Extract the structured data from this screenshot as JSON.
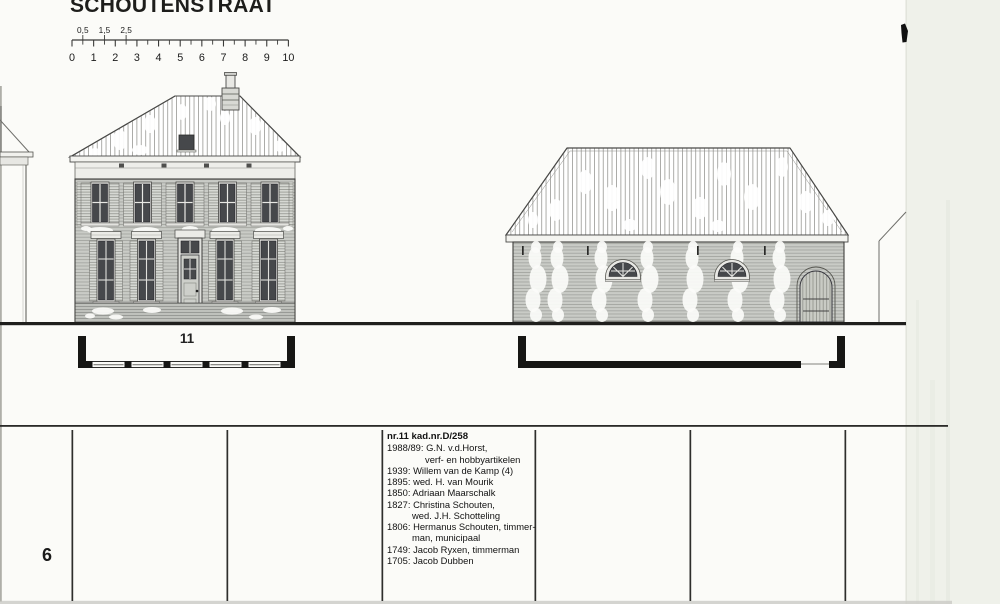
{
  "header": {
    "title": "SCHOUTENSTRAAT"
  },
  "scale_bar": {
    "unit_labels": [
      "0",
      "1",
      "2",
      "3",
      "4",
      "5",
      "6",
      "7",
      "8",
      "9",
      "10"
    ],
    "half_labels": [
      {
        "label": "0,5",
        "unit": 0.5
      },
      {
        "label": "1,5",
        "unit": 1.5
      },
      {
        "label": "2,5",
        "unit": 2.5
      }
    ]
  },
  "plans": {
    "left_building_number": "11"
  },
  "history": {
    "heading": "nr.11 kad.nr.D/258",
    "entries": [
      {
        "text": "1988/89: G.N. v.d.Horst,",
        "indent": 0
      },
      {
        "text": "verf- en hobbyartikelen",
        "indent": 2
      },
      {
        "text": "1939: Willem van de Kamp (4)",
        "indent": 0
      },
      {
        "text": "1895: wed. H. van Mourik",
        "indent": 0
      },
      {
        "text": "1850: Adriaan Maarschalk",
        "indent": 0
      },
      {
        "text": "1827: Christina Schouten,",
        "indent": 0
      },
      {
        "text": "wed. J.H. Schotteling",
        "indent": 1
      },
      {
        "text": "1806: Hermanus Schouten, timmer-",
        "indent": 0
      },
      {
        "text": "man, municipaal",
        "indent": 1
      },
      {
        "text": "1749: Jacob Ryxen, timmerman",
        "indent": 0
      },
      {
        "text": "1705: Jacob Dubben",
        "indent": 0
      }
    ]
  },
  "footer": {
    "page_number": "6"
  },
  "colors": {
    "paper": "#fbfbf8",
    "ink": "#1d1d1b",
    "drawing_line": "#3f3f3d",
    "brick": "#c9cbc6",
    "roof_stripe": "#a4a4a0",
    "window_dark": "#46484b",
    "scan_margin": "#eff1ea"
  }
}
